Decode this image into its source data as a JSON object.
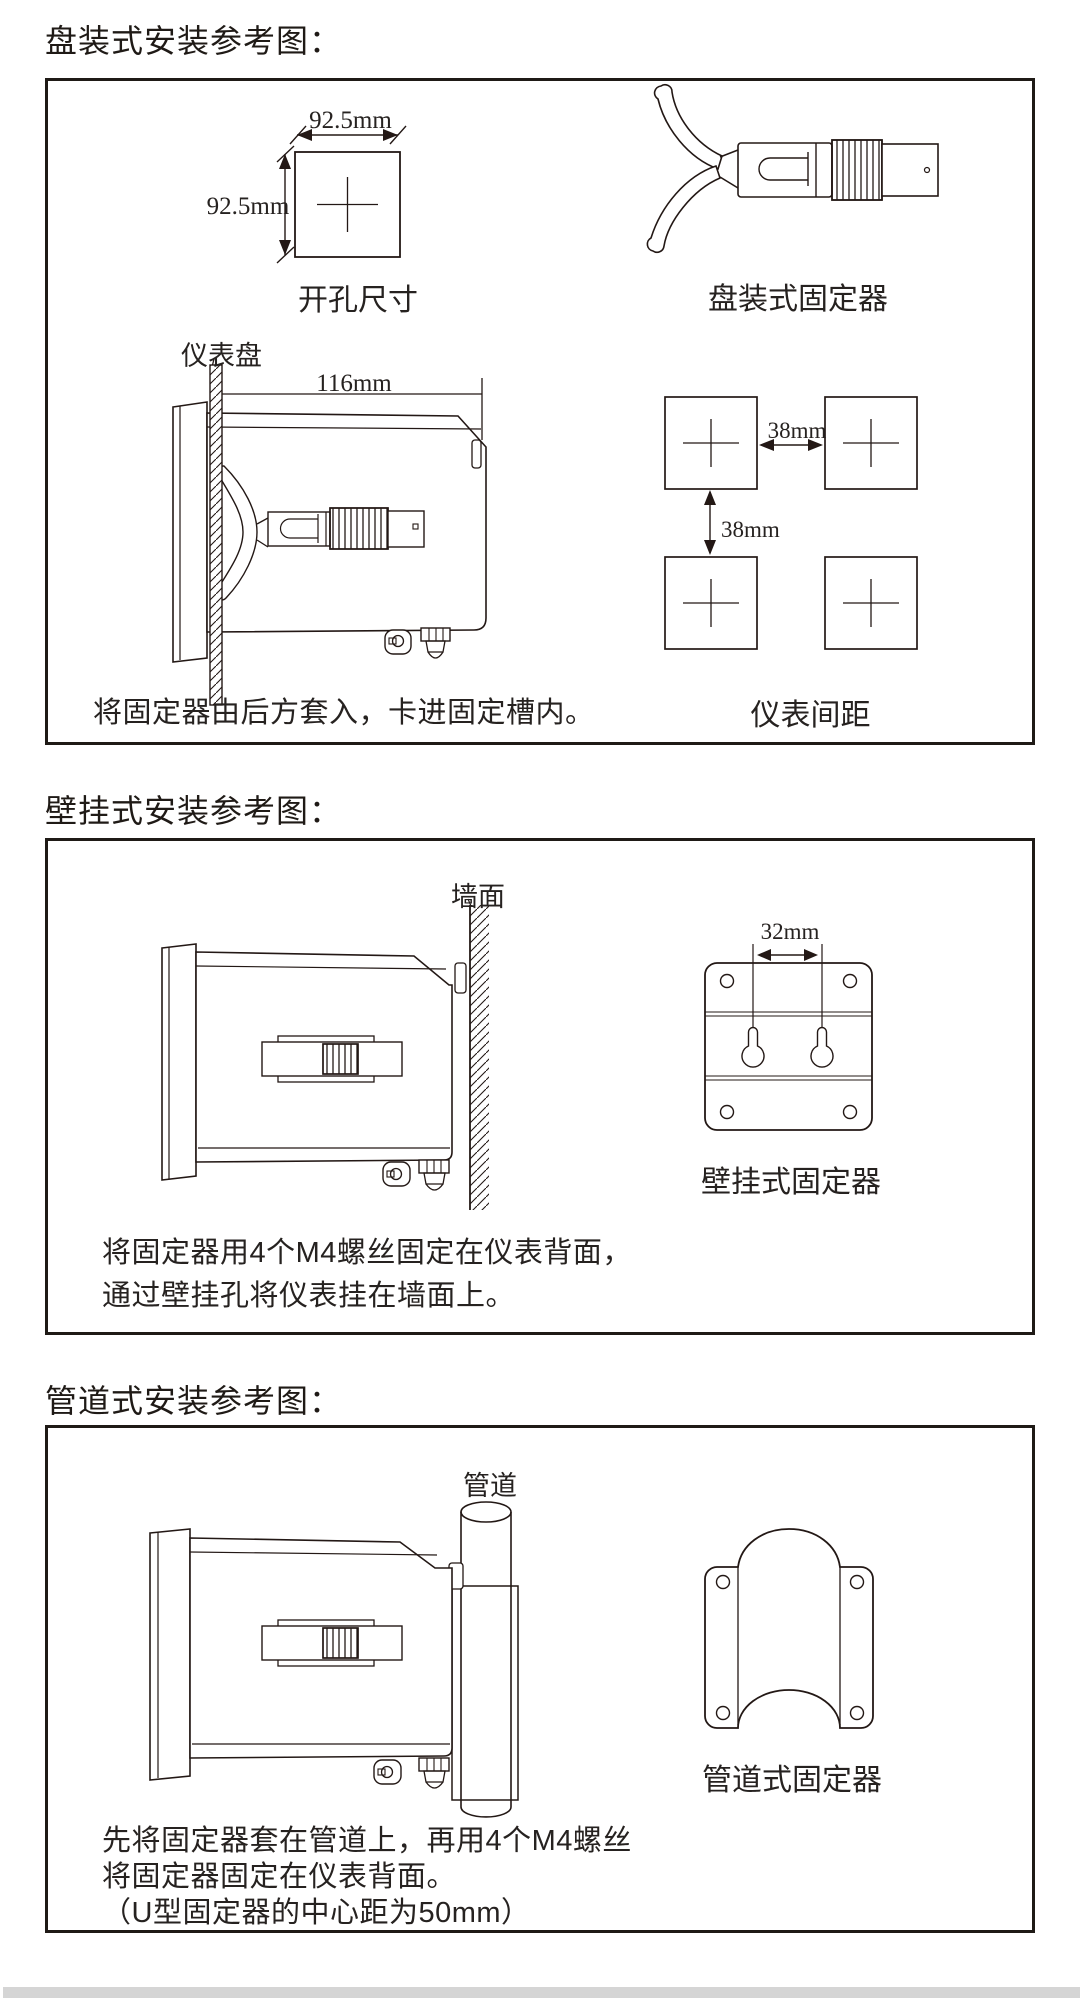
{
  "colors": {
    "ink": "#231815",
    "footer_bar": "#d5d5d5",
    "background": "#ffffff"
  },
  "sections": {
    "panel": {
      "title": "盘装式安装参考图：",
      "cutout_label": "开孔尺寸",
      "cutout_width": "92.5mm",
      "cutout_height": "92.5mm",
      "fixer_label": "盘装式固定器",
      "panel_label": "仪表盘",
      "depth_dim": "116mm",
      "gap_h": "38mm",
      "gap_v": "38mm",
      "spacing_label": "仪表间距",
      "caption": "将固定器由后方套入，卡进固定槽内。"
    },
    "wall": {
      "title": "壁挂式安装参考图：",
      "wall_label": "墙面",
      "hole_dim": "32mm",
      "fixer_label": "壁挂式固定器",
      "caption_line1": "将固定器用4个M4螺丝固定在仪表背面，",
      "caption_line2": "通过壁挂孔将仪表挂在墙面上。"
    },
    "pipe": {
      "title": "管道式安装参考图：",
      "pipe_label": "管道",
      "fixer_label": "管道式固定器",
      "caption_line1": "先将固定器套在管道上，再用4个M4螺丝",
      "caption_line2": "将固定器固定在仪表背面。",
      "caption_line3": "（U型固定器的中心距为50mm）"
    }
  }
}
